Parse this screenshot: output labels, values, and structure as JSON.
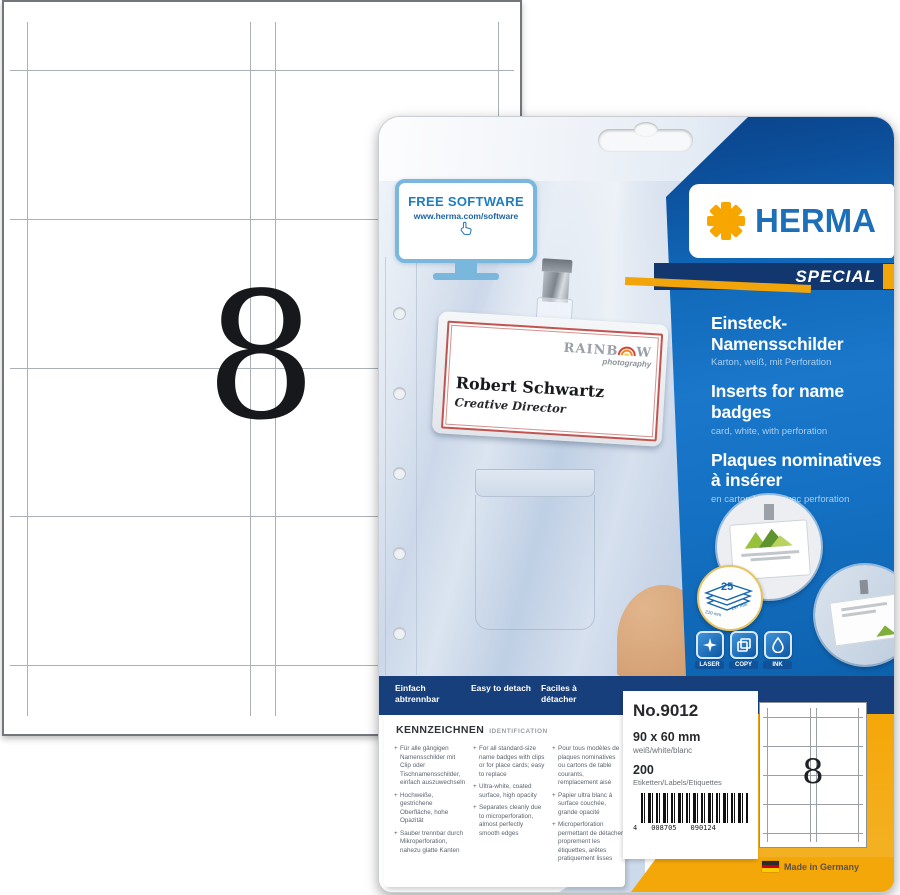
{
  "sheet": {
    "count": "8"
  },
  "package": {
    "free_software": {
      "title": "FREE SOFTWARE",
      "url": "www.herma.com/software"
    },
    "badge": {
      "brand_start": "RAINB",
      "brand_end": "W",
      "brand_sub": "photography",
      "name": "Robert Schwartz",
      "role": "Creative Director"
    },
    "brand": {
      "name": "HERMA",
      "special": "SPECIAL"
    },
    "titles": [
      {
        "t": "Einsteck-Namensschilder",
        "s": "Karton, weiß, mit Perforation"
      },
      {
        "t": "Inserts for name badges",
        "s": "card, white, with perforation"
      },
      {
        "t": "Plaques nominatives à insérer",
        "s": "en carton blanc, avec perforation"
      }
    ],
    "sheets_icon": {
      "count": "25",
      "dim_w": "210 mm",
      "dim_h": "297 mm"
    },
    "print_icons": [
      {
        "label": "LASER"
      },
      {
        "label": "COPY"
      },
      {
        "label": "INK"
      }
    ],
    "detach": [
      "Einfach abtrennbar",
      "Easy to detach",
      "Faciles à détacher"
    ],
    "kennzeichnen": {
      "heading": "KENNZEICHNEN",
      "subheading": "IDENTIFICATION",
      "columns": [
        {
          "bullets": [
            "Für alle gängigen Namensschilder mit Clip oder Tischnamensschilder, einfach auszuwechseln",
            "Hochweiße, gestrichene Oberfläche, hohe Opazität",
            "Sauber trennbar durch Mikroperforation, nahezu glatte Kanten"
          ]
        },
        {
          "bullets": [
            "For all standard-size name badges with clips or for place cards; easy to replace",
            "Ultra-white, coated surface, high opacity",
            "Separates cleanly due to microperforation, almost perfectly smooth edges"
          ]
        },
        {
          "bullets": [
            "Pour tous modèles de plaques nominatives ou cartons de table courants, remplacement aisé",
            "Papier ultra blanc à surface couchée, grande opacité",
            "Microperforation permettant de détacher proprement les étiquettes, arêtes pratiquement lisses"
          ]
        }
      ]
    },
    "info": {
      "number": "No.9012",
      "size": "90 x 60 mm",
      "color": "weiß/white/blanc",
      "count": "200",
      "count_label": "Etiketten/Labels/Etiquettes",
      "barcode_left": "4",
      "barcode_a": "008705",
      "barcode_b": "090124"
    },
    "mini_sheet": {
      "count": "8"
    },
    "made_in": "Made in Germany"
  }
}
